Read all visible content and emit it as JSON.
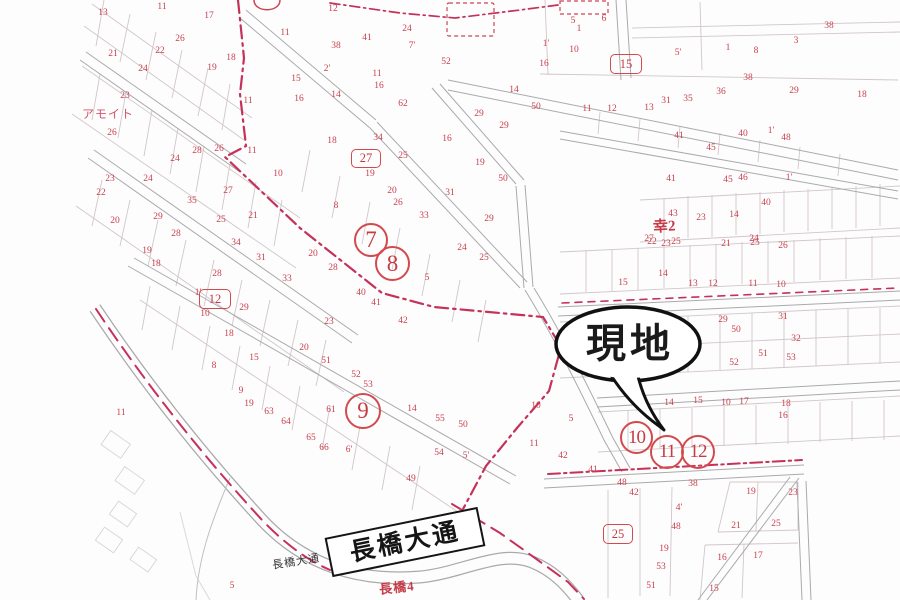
{
  "map": {
    "site_callout": {
      "label": "現地"
    },
    "road_sign": {
      "label": "長橋大通"
    },
    "labels": {
      "small_road": "長橋大通",
      "district_red": "長橋4",
      "sachi": "幸2",
      "amoi": "アモイト"
    },
    "circle_markers": [
      {
        "label": "7"
      },
      {
        "label": "8"
      },
      {
        "label": "9"
      },
      {
        "label": "10"
      },
      {
        "label": "11"
      },
      {
        "label": "12"
      }
    ],
    "box_markers": [
      {
        "label": "15"
      },
      {
        "label": "27"
      },
      {
        "label": "12"
      },
      {
        "label": "25"
      }
    ],
    "colors": {
      "marker_red": "#d24a4e",
      "boundary_red": "#c5315a",
      "parcel_number_red": "#c8414f",
      "street_gray": "#a9aaad",
      "parcel_line_pink": "#d2c6cb",
      "callout_ink": "#1a1a1a"
    },
    "parcel_numbers": [
      [
        103,
        13,
        "13"
      ],
      [
        162,
        7,
        "11"
      ],
      [
        209,
        16,
        "17"
      ],
      [
        180,
        39,
        "26"
      ],
      [
        113,
        54,
        "21"
      ],
      [
        160,
        51,
        "22"
      ],
      [
        143,
        69,
        "24"
      ],
      [
        212,
        68,
        "19"
      ],
      [
        231,
        58,
        "18"
      ],
      [
        125,
        96,
        "23"
      ],
      [
        248,
        101,
        "11"
      ],
      [
        112,
        133,
        "26"
      ],
      [
        175,
        159,
        "24"
      ],
      [
        197,
        151,
        "28"
      ],
      [
        219,
        149,
        "26"
      ],
      [
        110,
        179,
        "23"
      ],
      [
        148,
        179,
        "24"
      ],
      [
        101,
        193,
        "22"
      ],
      [
        192,
        201,
        "35"
      ],
      [
        228,
        191,
        "27"
      ],
      [
        333,
        9,
        "12"
      ],
      [
        285,
        33,
        "11"
      ],
      [
        407,
        29,
        "24"
      ],
      [
        367,
        38,
        "41"
      ],
      [
        336,
        46,
        "38"
      ],
      [
        412,
        46,
        "7'"
      ],
      [
        327,
        69,
        "2'"
      ],
      [
        377,
        74,
        "11"
      ],
      [
        379,
        86,
        "16"
      ],
      [
        296,
        79,
        "15"
      ],
      [
        299,
        99,
        "16"
      ],
      [
        336,
        95,
        "14"
      ],
      [
        403,
        104,
        "62"
      ],
      [
        446,
        62,
        "52"
      ],
      [
        546,
        44,
        "1'"
      ],
      [
        544,
        64,
        "16"
      ],
      [
        574,
        50,
        "10"
      ],
      [
        514,
        90,
        "14"
      ],
      [
        479,
        114,
        "29"
      ],
      [
        504,
        126,
        "29"
      ],
      [
        536,
        107,
        "50"
      ],
      [
        573,
        21,
        "5"
      ],
      [
        604,
        19,
        "6"
      ],
      [
        579,
        29,
        "1"
      ],
      [
        332,
        141,
        "18"
      ],
      [
        378,
        138,
        "34"
      ],
      [
        447,
        139,
        "16"
      ],
      [
        403,
        156,
        "25"
      ],
      [
        370,
        174,
        "19"
      ],
      [
        480,
        163,
        "19"
      ],
      [
        503,
        179,
        "50"
      ],
      [
        392,
        191,
        "20"
      ],
      [
        450,
        193,
        "31"
      ],
      [
        398,
        203,
        "26"
      ],
      [
        424,
        216,
        "33"
      ],
      [
        489,
        219,
        "29"
      ],
      [
        336,
        206,
        "8"
      ],
      [
        462,
        248,
        "24"
      ],
      [
        484,
        258,
        "25"
      ],
      [
        313,
        254,
        "20"
      ],
      [
        333,
        268,
        "28"
      ],
      [
        427,
        278,
        "5"
      ],
      [
        252,
        151,
        "11"
      ],
      [
        278,
        174,
        "10"
      ],
      [
        115,
        221,
        "20"
      ],
      [
        158,
        217,
        "29"
      ],
      [
        176,
        234,
        "28"
      ],
      [
        147,
        251,
        "19"
      ],
      [
        156,
        264,
        "18"
      ],
      [
        221,
        220,
        "25"
      ],
      [
        253,
        216,
        "21"
      ],
      [
        236,
        243,
        "34"
      ],
      [
        261,
        258,
        "31"
      ],
      [
        198,
        293,
        "1'"
      ],
      [
        244,
        308,
        "29"
      ],
      [
        205,
        314,
        "10"
      ],
      [
        229,
        334,
        "18"
      ],
      [
        329,
        322,
        "23"
      ],
      [
        287,
        279,
        "33"
      ],
      [
        217,
        274,
        "28"
      ],
      [
        254,
        358,
        "15"
      ],
      [
        214,
        366,
        "8"
      ],
      [
        241,
        391,
        "9"
      ],
      [
        249,
        404,
        "19"
      ],
      [
        269,
        412,
        "63"
      ],
      [
        286,
        422,
        "64"
      ],
      [
        311,
        438,
        "65"
      ],
      [
        324,
        448,
        "66"
      ],
      [
        349,
        450,
        "6'"
      ],
      [
        326,
        361,
        "51"
      ],
      [
        356,
        375,
        "52"
      ],
      [
        368,
        385,
        "53"
      ],
      [
        331,
        410,
        "61"
      ],
      [
        304,
        348,
        "20"
      ],
      [
        376,
        303,
        "41"
      ],
      [
        403,
        321,
        "42"
      ],
      [
        361,
        293,
        "40"
      ],
      [
        440,
        419,
        "55"
      ],
      [
        463,
        425,
        "50"
      ],
      [
        439,
        453,
        "54"
      ],
      [
        466,
        456,
        "5'"
      ],
      [
        411,
        479,
        "49"
      ],
      [
        412,
        409,
        "14"
      ],
      [
        121,
        413,
        "11"
      ],
      [
        232,
        586,
        "5"
      ],
      [
        536,
        406,
        "10"
      ],
      [
        571,
        419,
        "5"
      ],
      [
        534,
        444,
        "11"
      ],
      [
        563,
        456,
        "42"
      ],
      [
        593,
        470,
        "41"
      ],
      [
        622,
        483,
        "48"
      ],
      [
        634,
        493,
        "42"
      ],
      [
        693,
        484,
        "38"
      ],
      [
        679,
        508,
        "4'"
      ],
      [
        676,
        527,
        "48"
      ],
      [
        664,
        549,
        "19"
      ],
      [
        661,
        567,
        "53"
      ],
      [
        651,
        586,
        "51"
      ],
      [
        751,
        492,
        "19"
      ],
      [
        793,
        493,
        "23"
      ],
      [
        736,
        526,
        "21"
      ],
      [
        776,
        524,
        "25"
      ],
      [
        722,
        558,
        "16"
      ],
      [
        758,
        556,
        "17"
      ],
      [
        714,
        589,
        "15"
      ],
      [
        652,
        242,
        "22"
      ],
      [
        676,
        242,
        "25"
      ],
      [
        726,
        244,
        "21"
      ],
      [
        755,
        243,
        "25"
      ],
      [
        783,
        246,
        "26"
      ],
      [
        663,
        274,
        "14"
      ],
      [
        623,
        283,
        "15"
      ],
      [
        693,
        284,
        "13"
      ],
      [
        713,
        284,
        "12"
      ],
      [
        753,
        284,
        "11"
      ],
      [
        781,
        285,
        "10"
      ],
      [
        723,
        320,
        "29"
      ],
      [
        736,
        330,
        "50"
      ],
      [
        783,
        317,
        "31"
      ],
      [
        796,
        339,
        "32"
      ],
      [
        734,
        363,
        "52"
      ],
      [
        763,
        354,
        "51"
      ],
      [
        791,
        358,
        "53"
      ],
      [
        669,
        403,
        "14"
      ],
      [
        698,
        401,
        "15"
      ],
      [
        726,
        403,
        "10"
      ],
      [
        744,
        402,
        "17"
      ],
      [
        786,
        404,
        "18"
      ],
      [
        783,
        416,
        "16"
      ],
      [
        587,
        109,
        "11"
      ],
      [
        612,
        109,
        "12"
      ],
      [
        649,
        108,
        "13"
      ],
      [
        666,
        101,
        "31"
      ],
      [
        688,
        99,
        "35"
      ],
      [
        721,
        92,
        "36"
      ],
      [
        748,
        78,
        "38"
      ],
      [
        794,
        91,
        "29"
      ],
      [
        679,
        136,
        "41"
      ],
      [
        711,
        148,
        "45"
      ],
      [
        743,
        134,
        "40"
      ],
      [
        771,
        131,
        "1'"
      ],
      [
        786,
        138,
        "48"
      ],
      [
        671,
        179,
        "41"
      ],
      [
        728,
        180,
        "45"
      ],
      [
        743,
        178,
        "46"
      ],
      [
        789,
        178,
        "1'"
      ],
      [
        766,
        203,
        "40"
      ],
      [
        673,
        214,
        "43"
      ],
      [
        701,
        218,
        "23"
      ],
      [
        734,
        215,
        "14"
      ],
      [
        649,
        239,
        "27"
      ],
      [
        666,
        244,
        "23"
      ],
      [
        754,
        239,
        "24"
      ],
      [
        829,
        26,
        "38"
      ],
      [
        862,
        95,
        "18"
      ],
      [
        756,
        51,
        "8"
      ],
      [
        678,
        53,
        "5'"
      ],
      [
        728,
        48,
        "1"
      ],
      [
        796,
        41,
        "3"
      ]
    ]
  }
}
